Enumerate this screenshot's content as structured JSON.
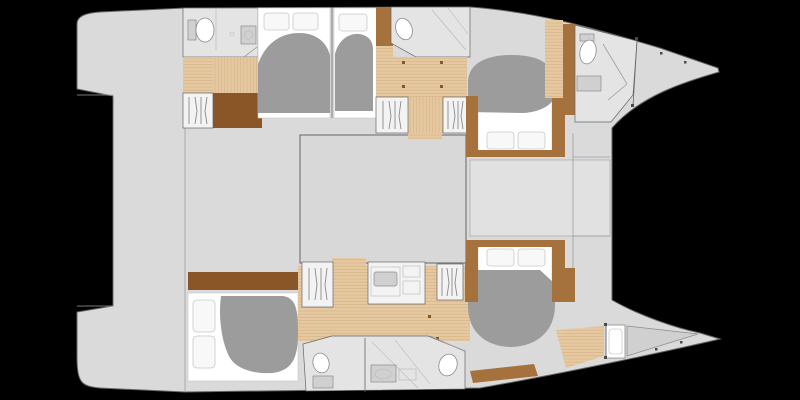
{
  "title": "Catamaran yacht interior layout floor plan, top view, bows to the right",
  "colors": {
    "background": "#000000",
    "hullDeck": "#dadada",
    "saloonFloor": "#d8d8d8",
    "loungeFloor": "#e1e1e1",
    "bathroomFloor": "#e4e4e4",
    "fixtureWhite": "#ffffff",
    "fixtureGrey": "#d0d0d0",
    "fixtureLine": "#8c8c8c",
    "woodFloor": "#e6c9a1",
    "woodSeam": "#d6b488",
    "furnitureDark": "#8a5628",
    "furnitureMid": "#a5713c",
    "duvet": "#9c9c9c",
    "mattress": "#ffffff",
    "pillow": "#f8f8f8",
    "pillowEdge": "#c9c9c9",
    "outline": "#666666",
    "detailLine": "#9e9e9e",
    "glassLine": "#b8b8b8",
    "stepBox": "#f3f3f3",
    "stepLine": "#8a8a8a",
    "marker": "#4a4a4a"
  },
  "areas": {
    "aft_platform": "aft transom platform and stern steps",
    "cockpit": "aft cockpit deck",
    "saloon": "central saloon",
    "foredeck_lounge": "forward cockpit lounge between hulls",
    "port_hull": {
      "cabins": [
        "aft double cabin",
        "mid single cabin",
        "forward double cabin"
      ],
      "heads": [
        "aft head with shower",
        "forward head with shower",
        "bow crew head"
      ]
    },
    "starboard_hull": {
      "cabins": [
        "aft double cabin",
        "forward double cabin"
      ],
      "heads": [
        "aft head",
        "forward head with shower"
      ],
      "bow": "crew berth compartment"
    }
  },
  "counts": {
    "double_berths": 5,
    "heads": 5,
    "companionway_stairs": 4,
    "crew_bow_compartments": 2
  }
}
